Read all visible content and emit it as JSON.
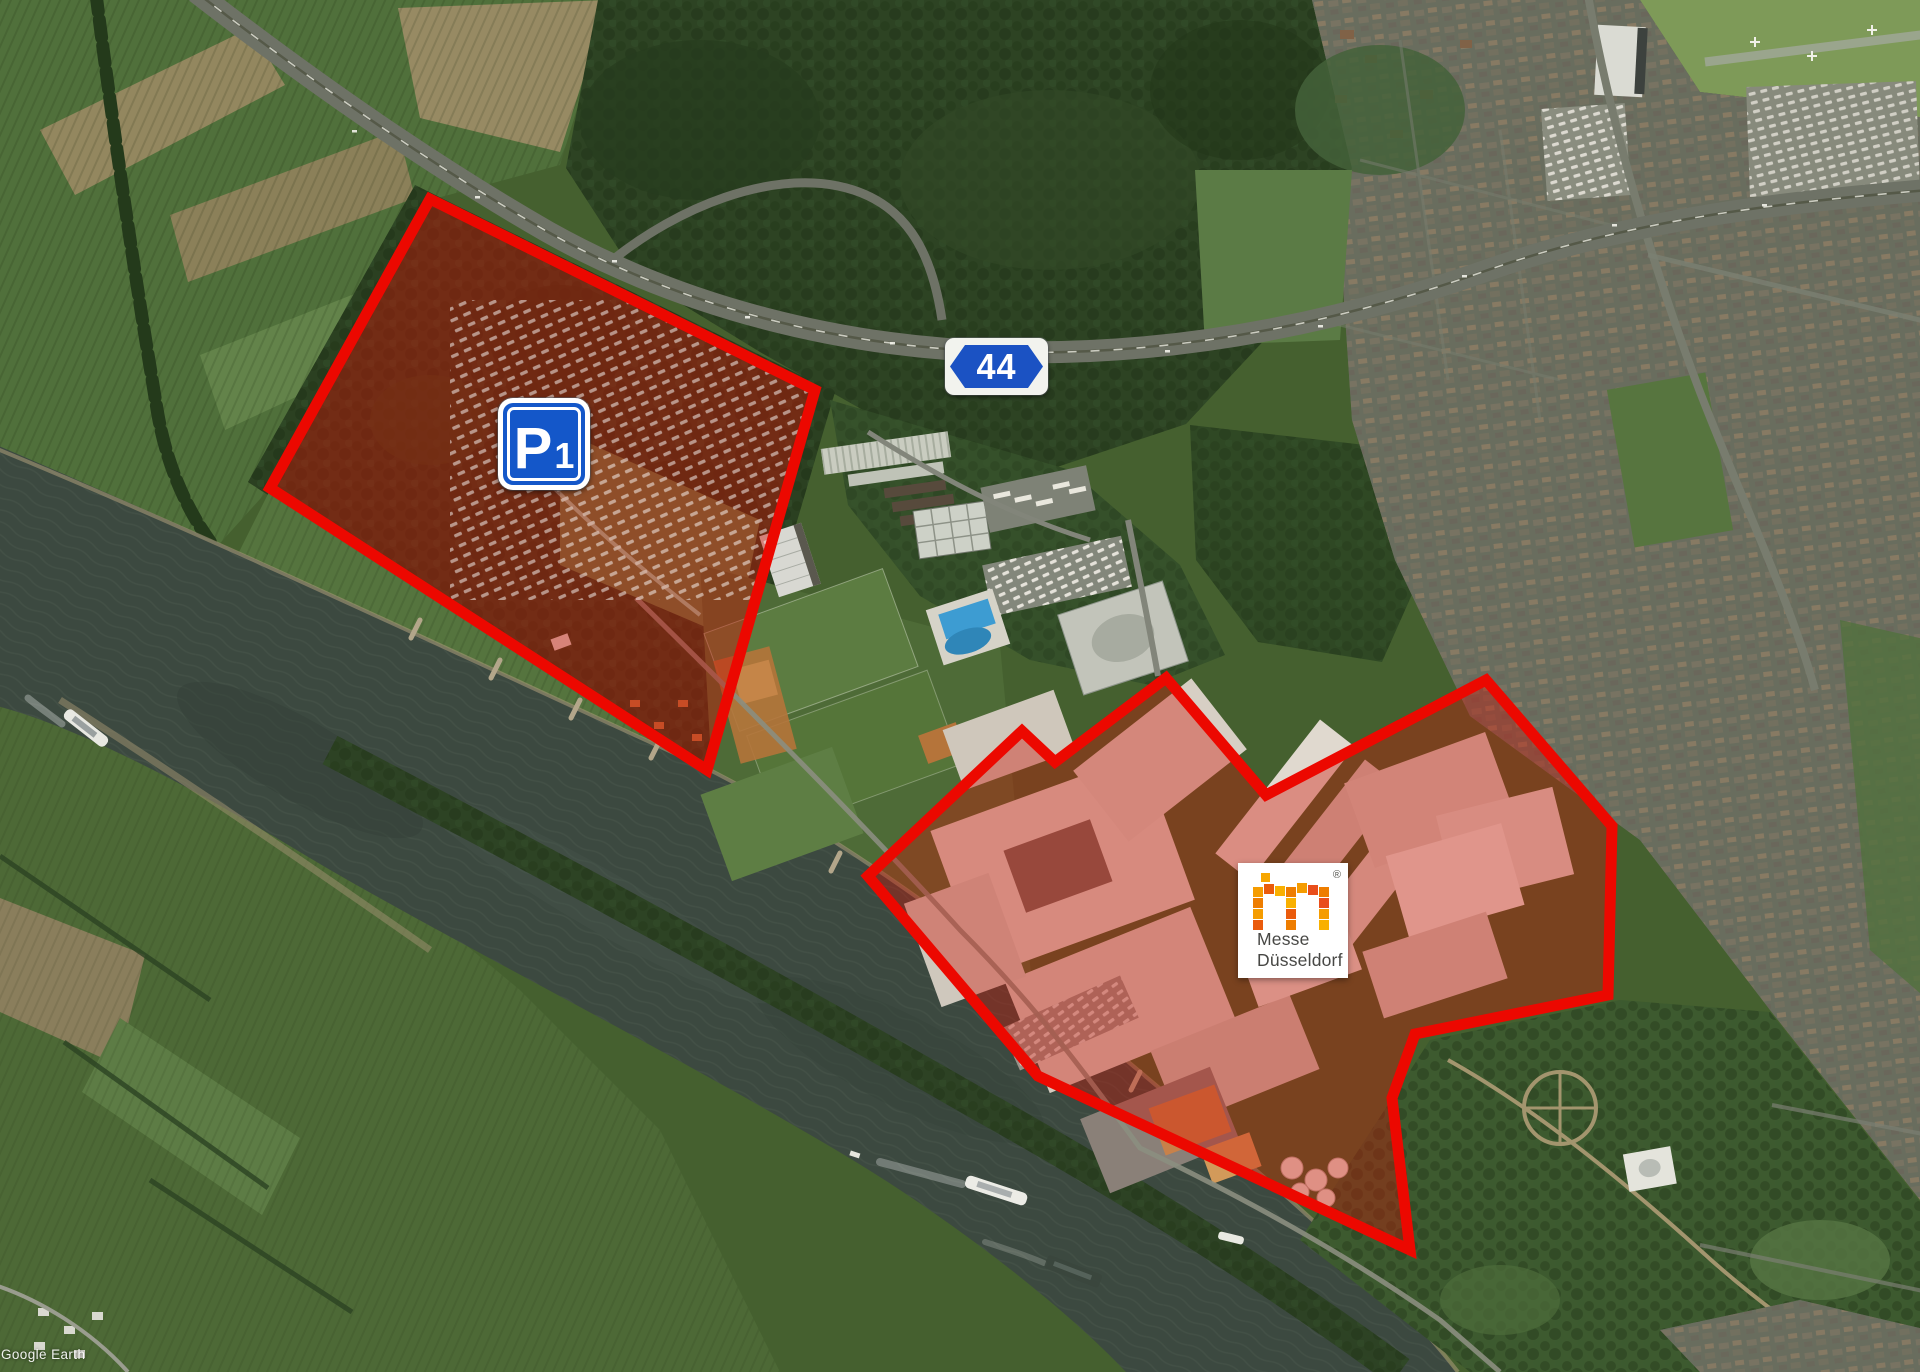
{
  "map": {
    "source_watermark": "Google Earth"
  },
  "overlays": {
    "p1_zone": {
      "points": "430,199 815,390 707,770 270,488",
      "fill": "rgba(208,18,6,0.44)",
      "stroke": "#ec0800",
      "stroke_width": "11"
    },
    "messe_zone": {
      "points": "868,876 1022,731 1055,762 1166,678 1266,795 1486,680 1612,826 1608,995 1415,1034 1392,1098 1410,1250 1038,1076",
      "fill": "rgba(208,18,6,0.38)",
      "stroke": "#ec0800",
      "stroke_width": "11"
    }
  },
  "signs": {
    "parking": {
      "p": "P",
      "one": "1",
      "panel_blue": "#1457c9"
    },
    "autobahn": {
      "number": "44",
      "panel_blue": "#1b52c3"
    }
  },
  "logo_card": {
    "line1": "Messe",
    "line2": "Düsseldorf",
    "registered": "®",
    "palette": [
      "#f9b000",
      "#f59c00",
      "#ee7d00",
      "#ea5b0c",
      "#e94e1b"
    ]
  },
  "colors": {
    "highlight_red": "#ec0800",
    "river_water": "#3c4940",
    "forest_green": "#2d4323",
    "field_green": "#50703b",
    "field_tan": "#93875f",
    "urban_gray": "#6a6e5f"
  }
}
